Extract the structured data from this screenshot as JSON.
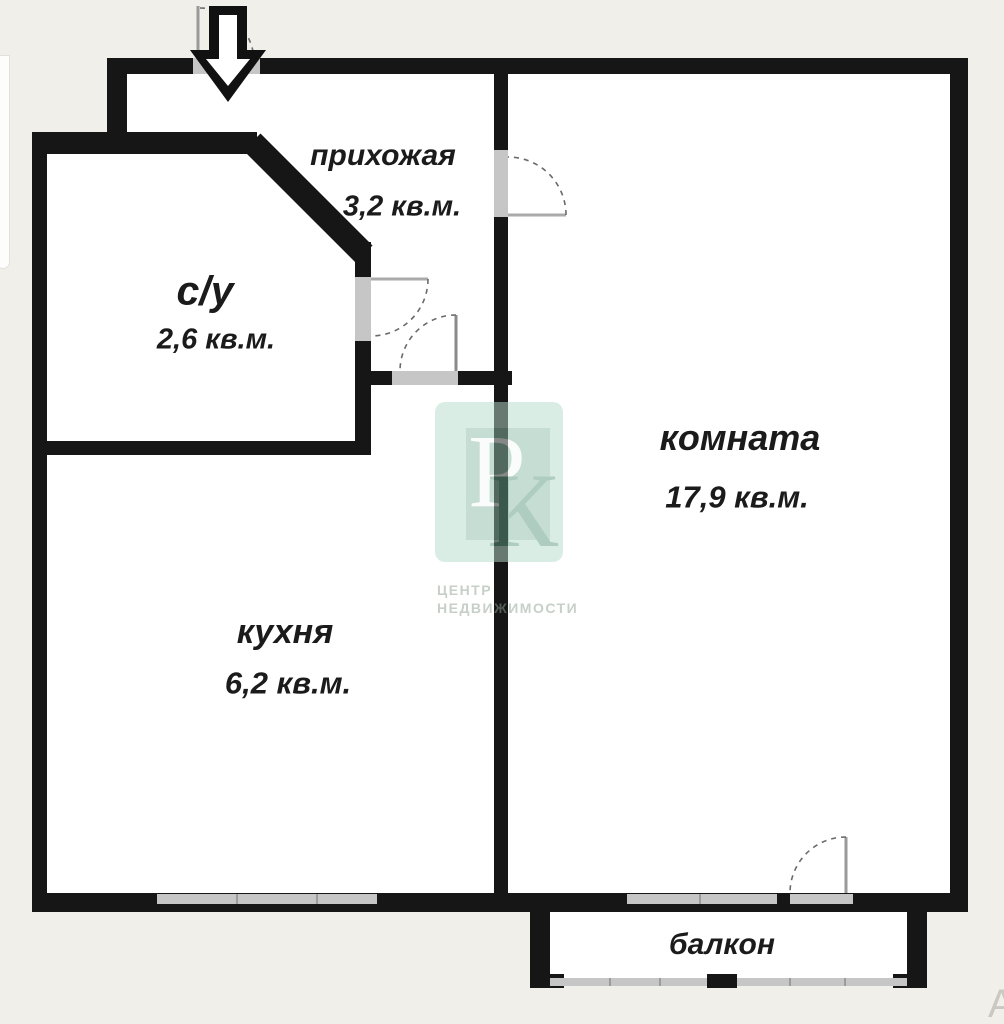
{
  "plan": {
    "title": "floor-plan",
    "rooms": {
      "hallway": {
        "name": "прихожая",
        "area": "3,2 кв.м."
      },
      "bathroom": {
        "name": "с/у",
        "area": "2,6 кв.м."
      },
      "room": {
        "name": "комната",
        "area": "17,9 кв.м."
      },
      "kitchen": {
        "name": "кухня",
        "area": "6,2 кв.м."
      },
      "balcony": {
        "name": "балкон"
      }
    }
  },
  "watermark": {
    "letter_top": "Р",
    "letter_bottom": "К",
    "caption_line1": "ЦЕНТР",
    "caption_line2": "НЕДВИЖИМОСТИ"
  },
  "artifacts": {
    "corner_letter": "А"
  },
  "colors": {
    "background": "#f0efea",
    "wall": "#161616",
    "opening": "#c6c6c6",
    "interior": "#ffffff",
    "watermark_green": "#b7dccc"
  }
}
